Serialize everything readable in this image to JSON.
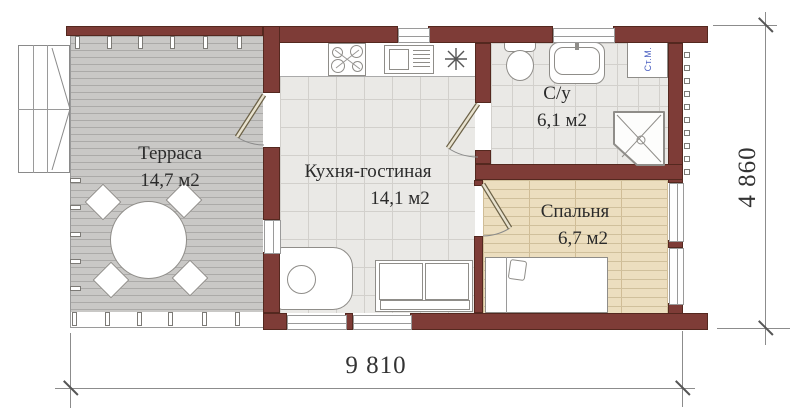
{
  "plan": {
    "rooms": [
      {
        "id": "terrace",
        "name": "Терраса",
        "area": "14,7 м2"
      },
      {
        "id": "kitchen_living",
        "name": "Кухня-гостиная",
        "area": "14,1 м2"
      },
      {
        "id": "bathroom",
        "name": "С/у",
        "area": "6,1 м2"
      },
      {
        "id": "bedroom",
        "name": "Спальня",
        "area": "6,7 м2"
      }
    ],
    "labels": {
      "washing_machine": "Ст.М."
    },
    "dimensions": {
      "total_width": "9 810",
      "total_height": "4 860"
    },
    "colors": {
      "wall": "#7e3c37",
      "wall_border": "#54281f",
      "deck": "#c9c8c6",
      "tile": "#eae9e6",
      "bedroom_floor": "#ecdebf",
      "bedroom_line": "#d0c09c",
      "accent_blue": "#4a5fc1"
    }
  }
}
